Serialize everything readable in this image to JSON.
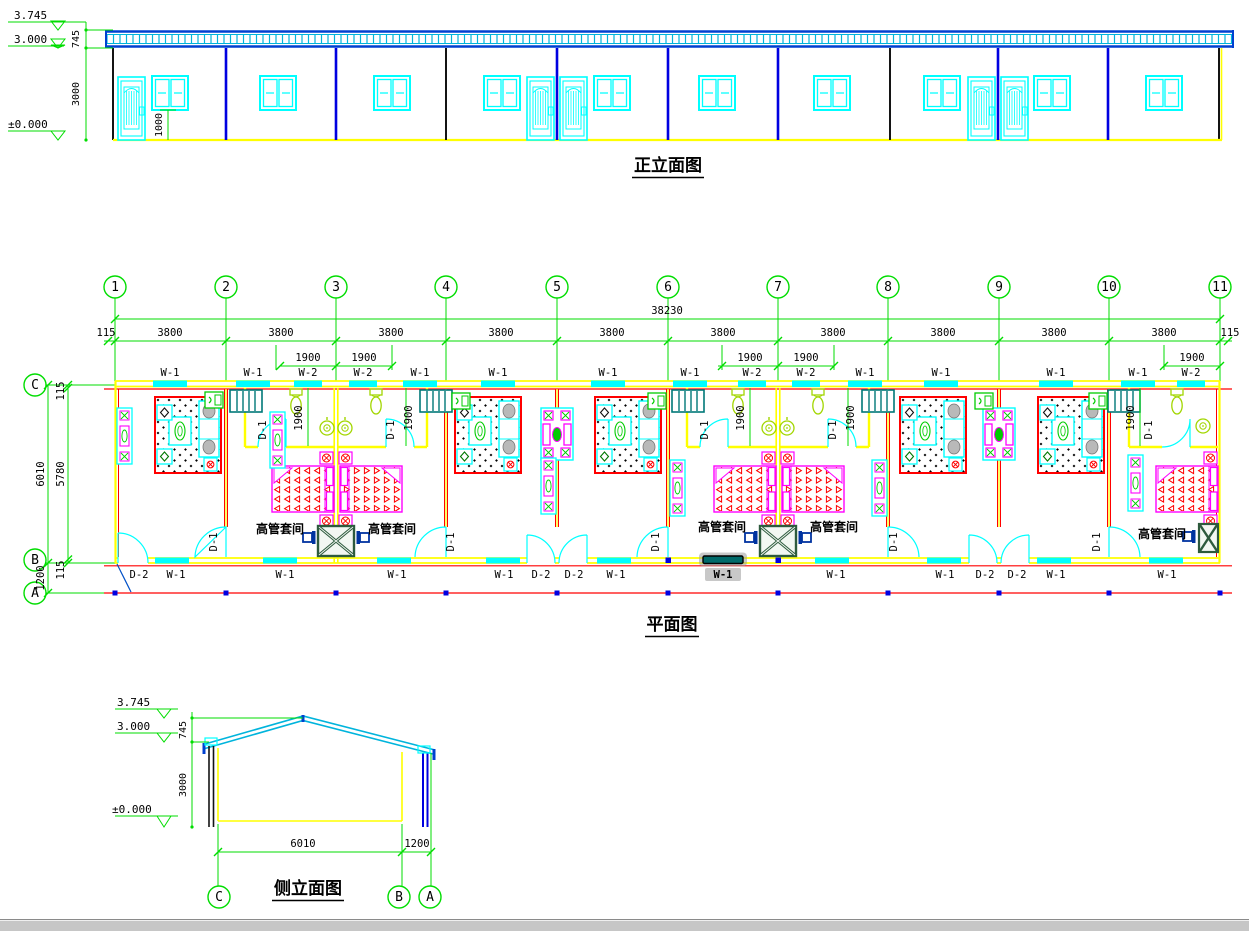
{
  "palette": {
    "dimension_green": "#00dd00",
    "window_cyan": "#00ffff",
    "wall_yellow": "#ffff00",
    "wall_red": "#ff0000",
    "furniture_magenta": "#ff00ff",
    "column_blue": "#0000e0",
    "cabinet_teal": "#007878",
    "fixture_chartreuse": "#a2d600",
    "table_darkgreen": "#2d5a3d",
    "selection_gray": "#9a9a9a"
  },
  "front_elevation": {
    "title": "正立面图",
    "levels": [
      "3.745",
      "3.000",
      "±0.000"
    ],
    "dims": {
      "roof_band": "745",
      "wall_height": "3000",
      "sill_height": "1000"
    }
  },
  "plan": {
    "title": "平面图",
    "grid_columns": [
      "1",
      "2",
      "3",
      "4",
      "5",
      "6",
      "7",
      "8",
      "9",
      "10",
      "11"
    ],
    "grid_rows": [
      "C",
      "B",
      "A"
    ],
    "dims": {
      "total_width": "38230",
      "bay": "3800",
      "end_offset": "115",
      "half_bay": "1900",
      "bath_depth": "1900",
      "depth_total": "6010",
      "depth_inner": "5780",
      "wall": "115",
      "canopy": "1200"
    },
    "tags": {
      "window1": "W-1",
      "window2": "W-2",
      "door1": "D-1",
      "door2": "D-2"
    },
    "room_label": "高管套间",
    "selected": {
      "tag": "W-1"
    }
  },
  "side_elevation": {
    "title": "侧立面图",
    "levels": [
      "3.745",
      "3.000",
      "±0.000"
    ],
    "dims": {
      "roof_band": "745",
      "wall_height": "3000",
      "span": "6010",
      "canopy": "1200"
    },
    "grid_rows": [
      "C",
      "B",
      "A"
    ]
  }
}
